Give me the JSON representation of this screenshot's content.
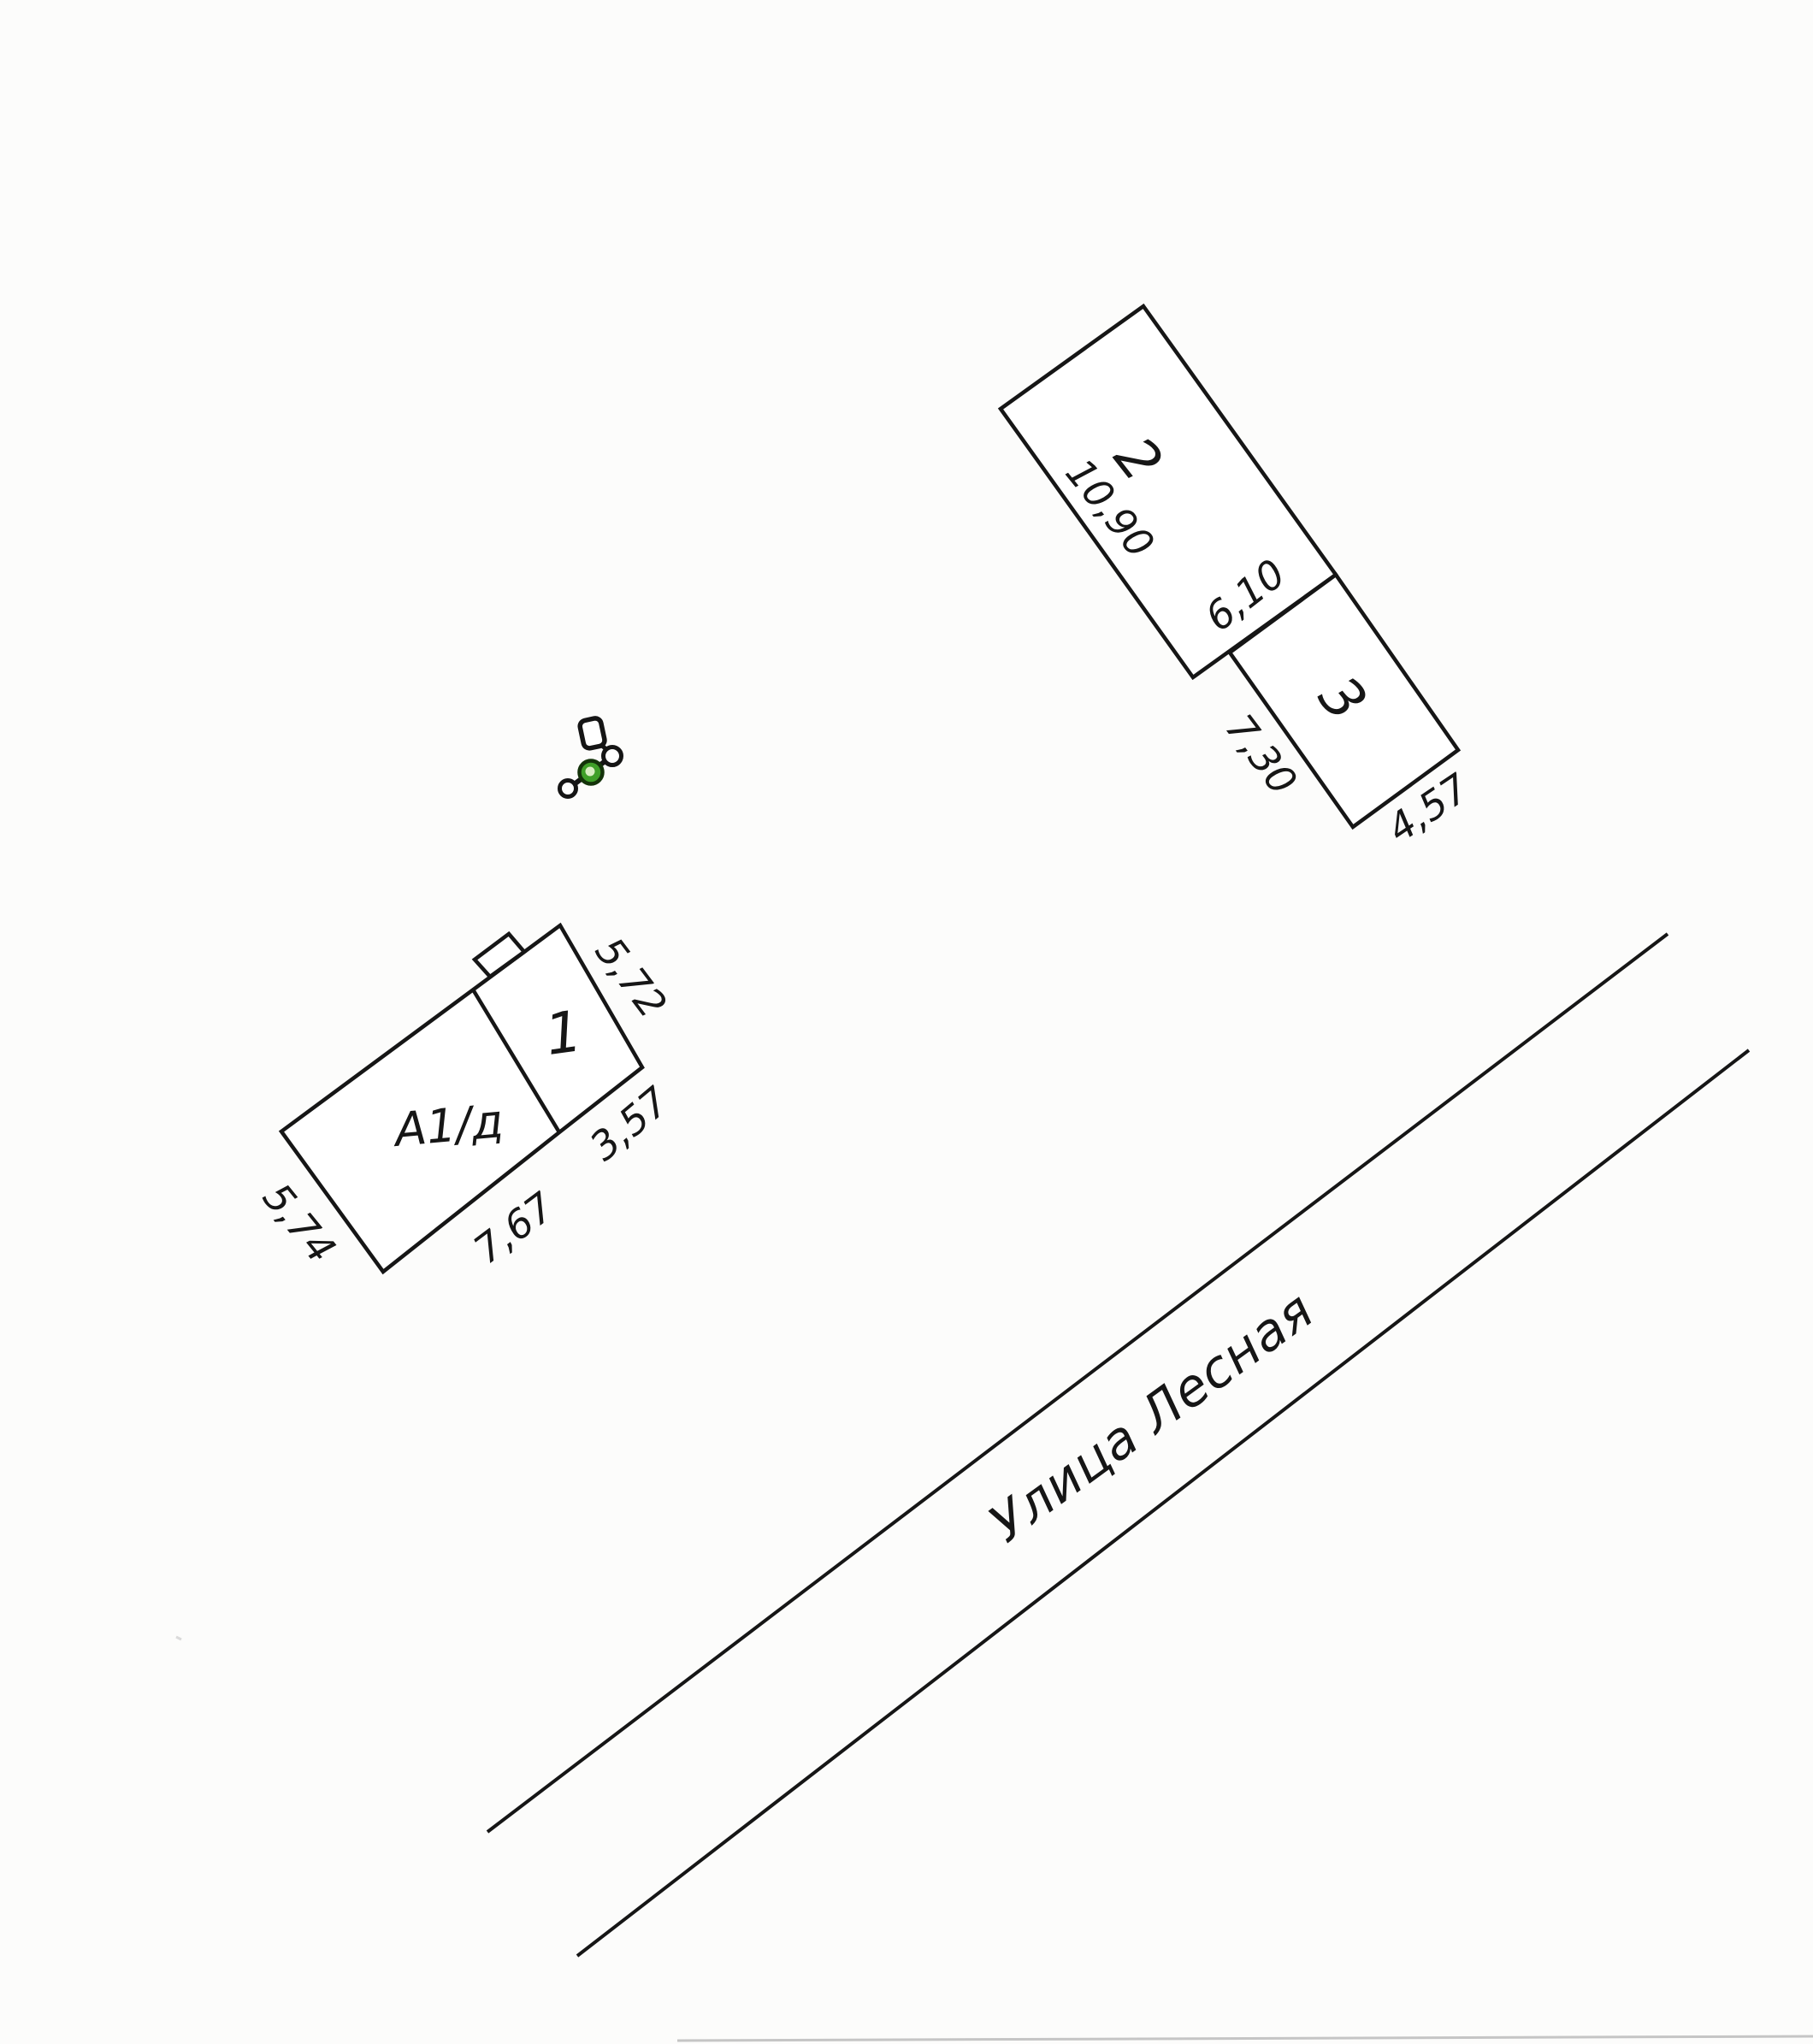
{
  "buildings": {
    "building_2": {
      "number": "2",
      "dim_length": "10,90",
      "dim_width": "6,10"
    },
    "building_3": {
      "number": "3",
      "dim_length": "7,30",
      "dim_width": "4,57"
    },
    "building_1": {
      "label": "А1/д",
      "number": "1",
      "dim_top_right": "5,72",
      "dim_right": "3,57",
      "dim_bottom": "7,67",
      "dim_left": "5,74"
    }
  },
  "street": {
    "name": "Улица Лесная"
  },
  "symbol": {
    "kind": "well-pole-marker",
    "green": "#3f9f28",
    "green_inner": "#d9eec3",
    "green_ring": "#14330a"
  },
  "colors": {
    "ink": "#161616",
    "paper": "#fcfcfb"
  }
}
